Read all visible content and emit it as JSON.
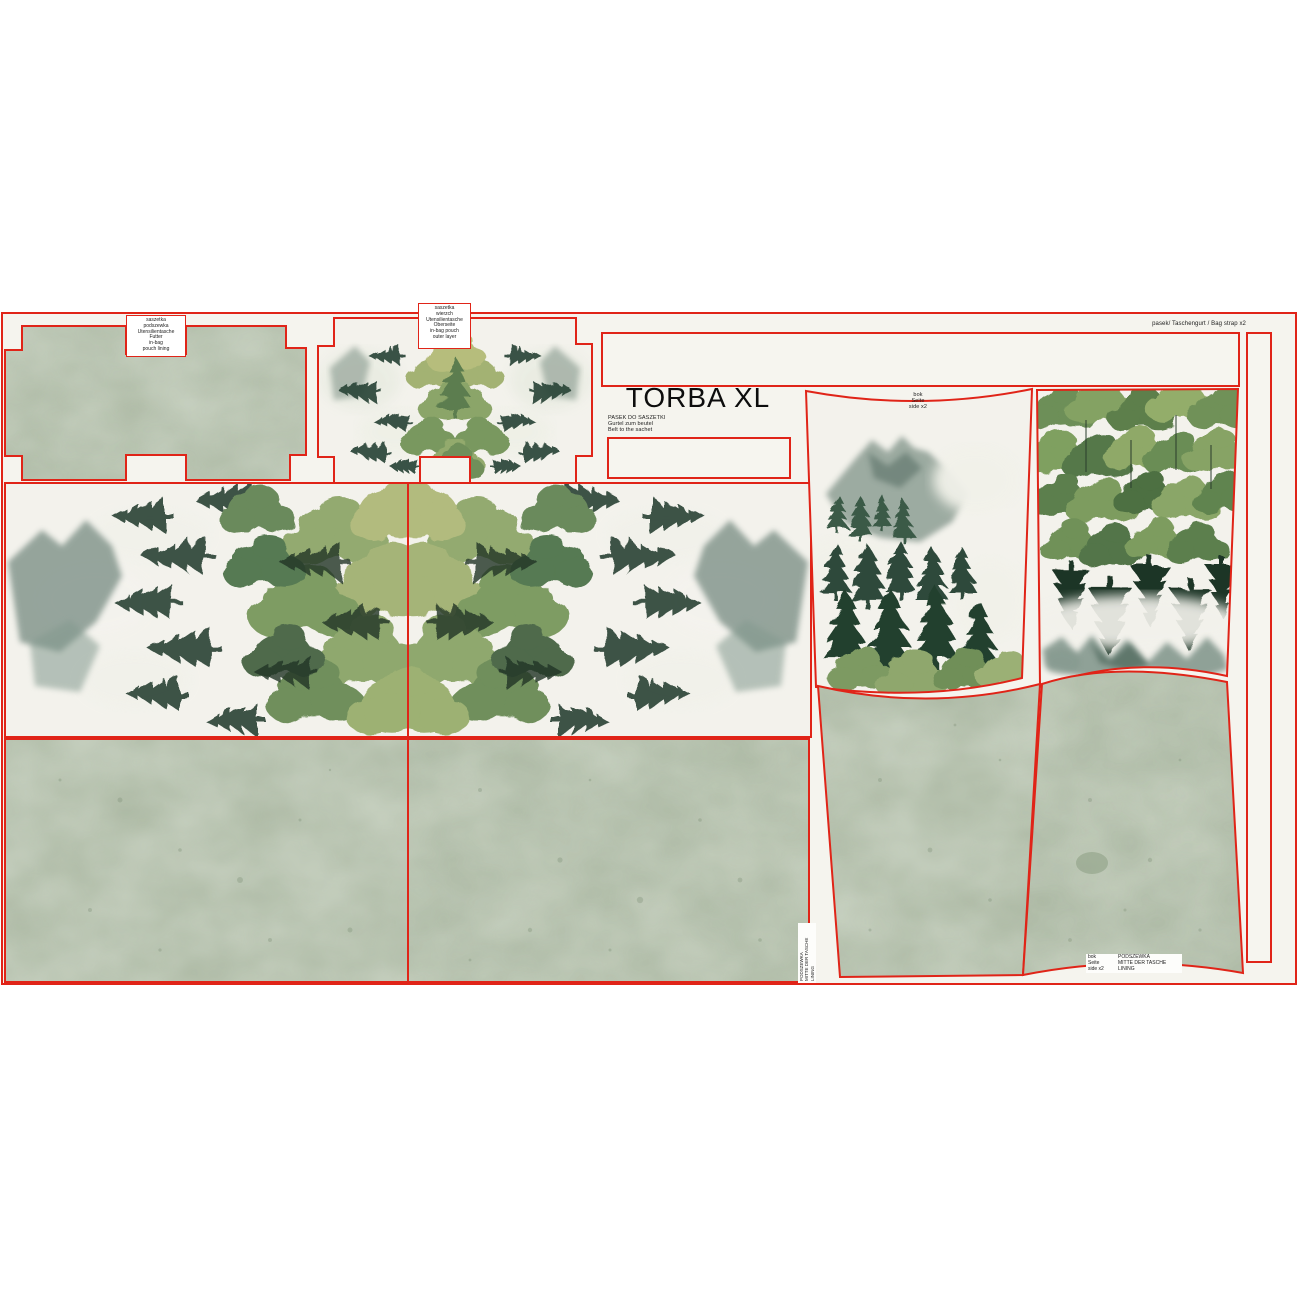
{
  "page": {
    "title": "TORBA XL"
  },
  "colors": {
    "outline_red": "#e02418",
    "panel_cream": "#f5f4ee",
    "fabric_sage": "#a9b6a0",
    "pine_dark": "#24402f",
    "foliage_light": "#9db077",
    "mountain_teal": "#647b6f"
  },
  "labels": {
    "pouch_lining": {
      "lines": [
        "saszetka",
        "podszewka",
        "Utensilientasche",
        "Futter",
        "in-bag",
        "pouch lining"
      ]
    },
    "pouch_outer": {
      "lines": [
        "saszetka",
        "wierzch",
        "Utensilientasche",
        "Oberseite",
        "in-bag pouch",
        "outer layer"
      ]
    },
    "belt": {
      "lines": [
        "PASEK DO SASZETKI",
        "Gurtel zum beutel",
        "Belt to the sachet"
      ]
    },
    "bag_strap": {
      "text": "pasek/ Taschengurt / Bag strap x2"
    },
    "side": {
      "lines": [
        "bok",
        "Seite",
        "side x2"
      ]
    },
    "lining_table": {
      "col1": [
        "bok",
        "Seite",
        "side x2"
      ],
      "col2": [
        "PODSZEWKA",
        "MITTE DER TASCHE",
        "LINING"
      ]
    },
    "lining_vertical": {
      "lines": [
        "PODSZEWKA",
        "MITTE DER TASCHE",
        "LINING"
      ]
    }
  }
}
